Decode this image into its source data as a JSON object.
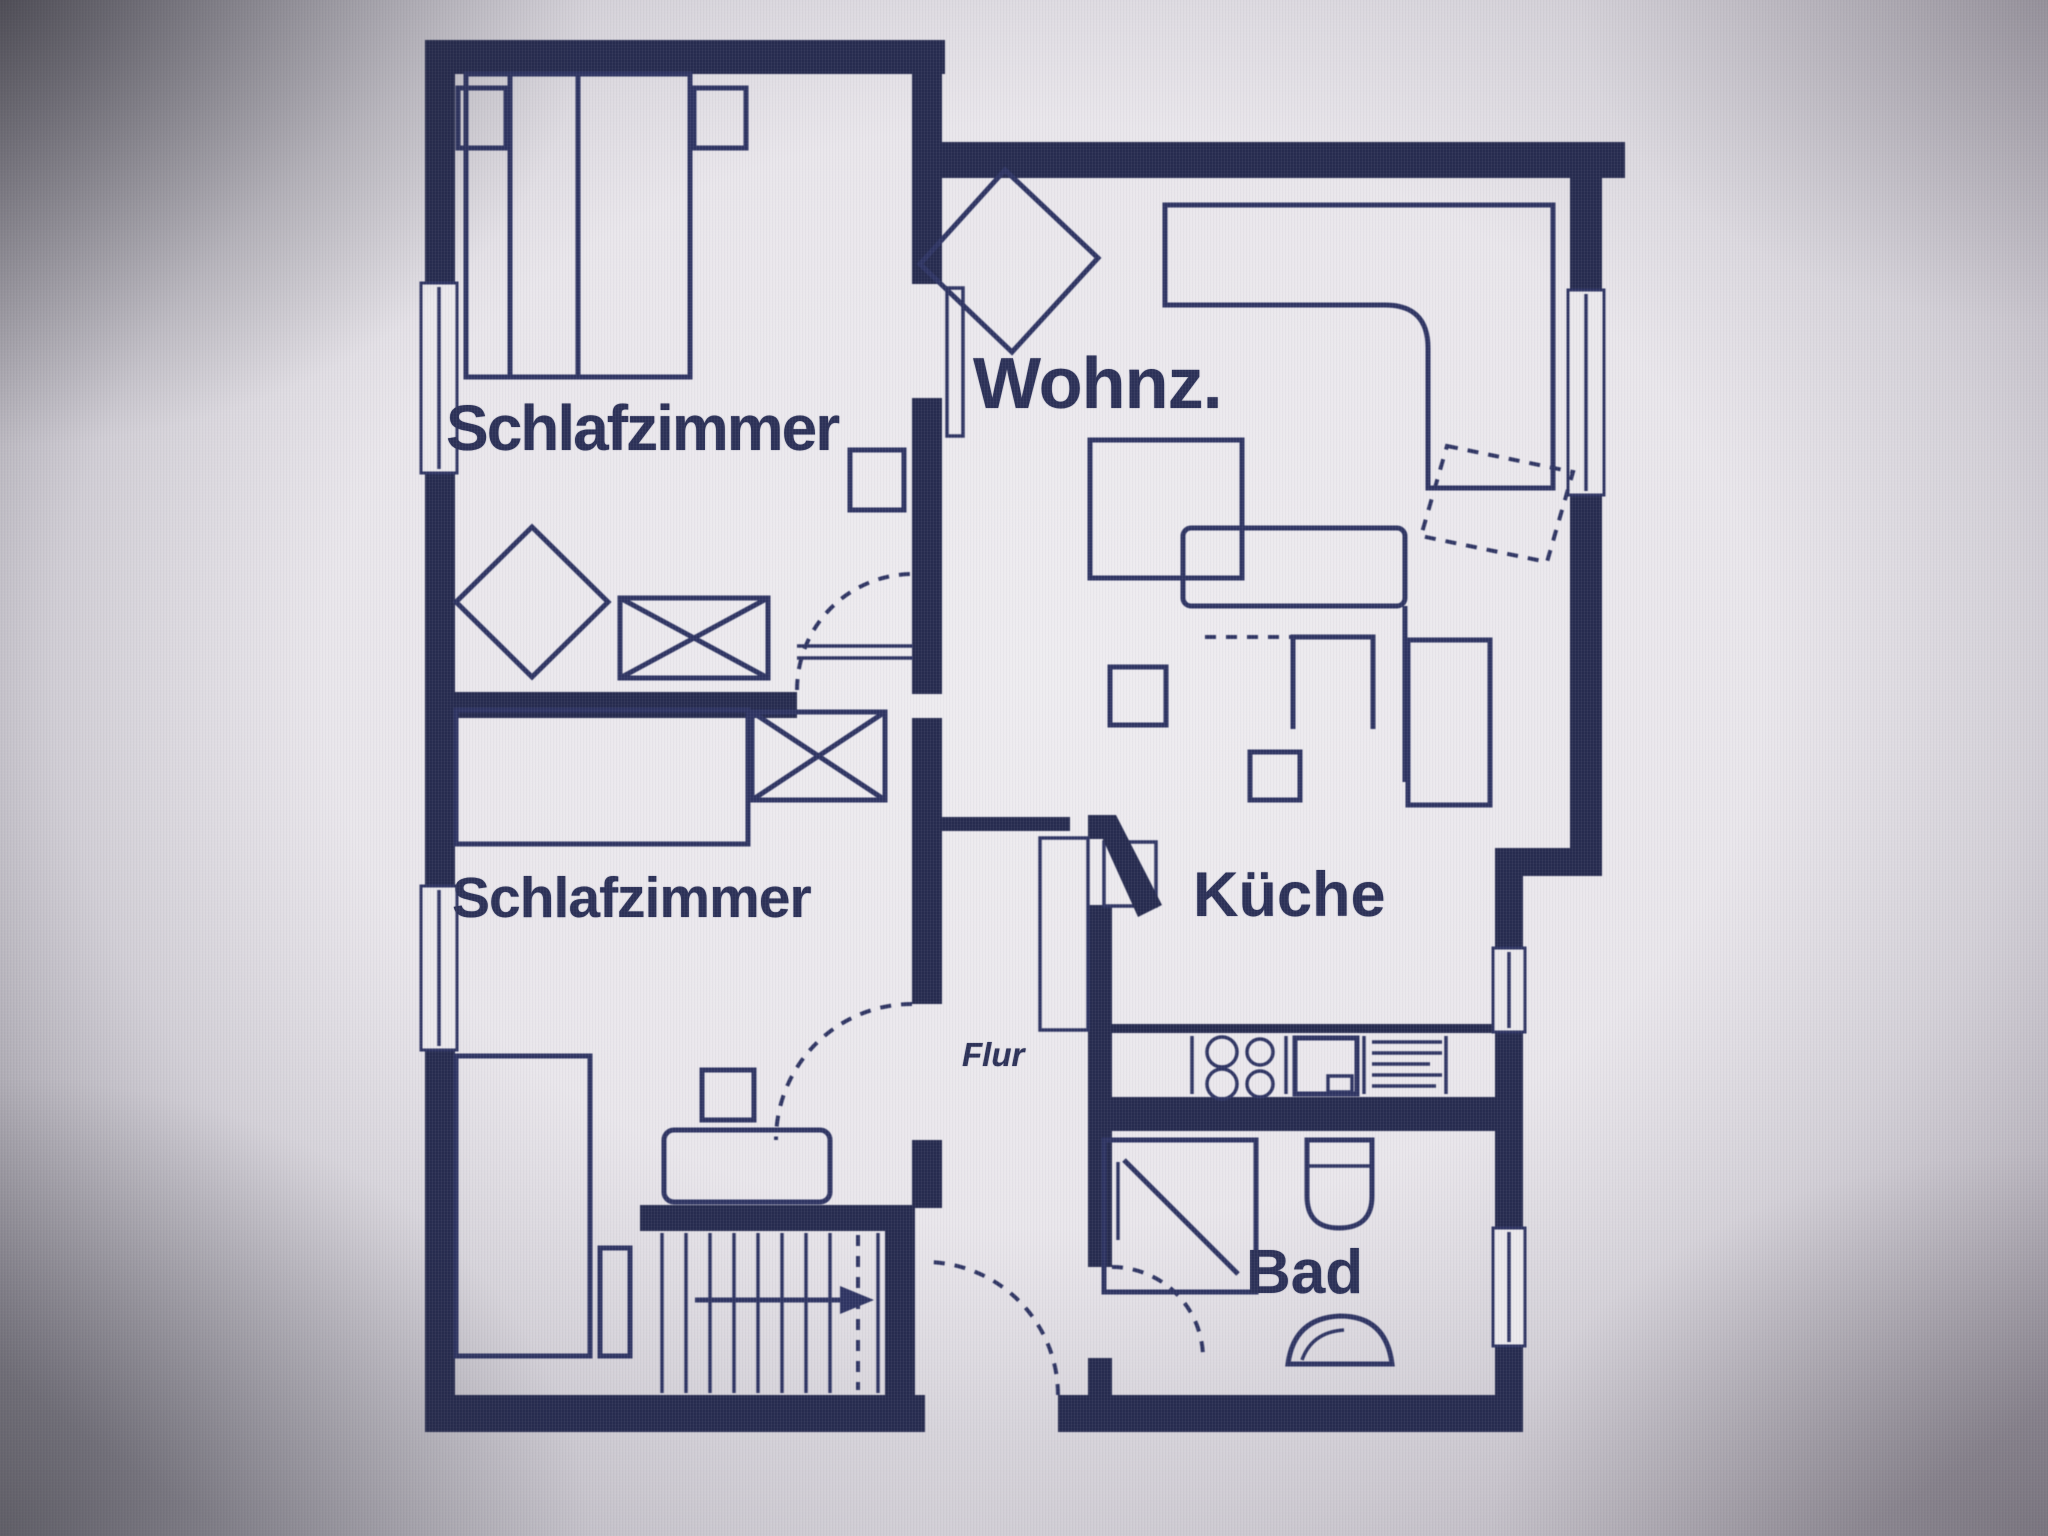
{
  "colors": {
    "ink": "#2f3563",
    "wall": "#272c50",
    "paper": "#eae8ec",
    "screen_gray": "#8e8b94"
  },
  "labels": {
    "bedroom_top": "Schlafzimmer",
    "living_room": "Wohnz.",
    "bedroom_bottom": "Schlafzimmer",
    "kitchen": "Küche",
    "bathroom": "Bad",
    "hallway": "Flur"
  }
}
